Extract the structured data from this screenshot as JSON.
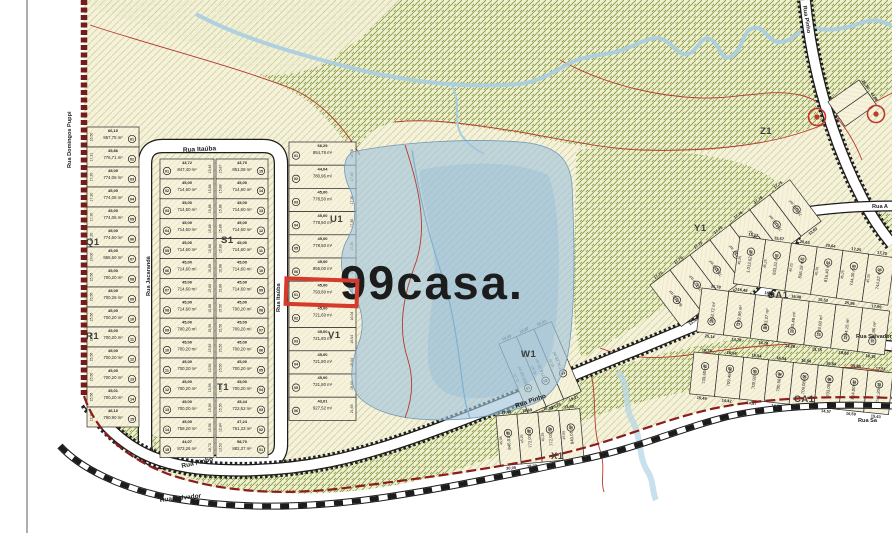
{
  "watermark": {
    "text": "99casa."
  },
  "streets": {
    "itauba": "Rua Itaúba",
    "jacaranda": "Rua Jacarandá",
    "pinho": "Rua Pinho",
    "salvador": "Rua Salvador",
    "salvador_short": "Rua Sa",
    "domingos": "Rua Domingos Puppi",
    "rua_a": "Rua A"
  },
  "highlight": {
    "block": "u1v1",
    "index": 6,
    "color": "#d63a2a"
  },
  "colors": {
    "land": "#f5f0d8",
    "forest_line": "#8a9a45",
    "lake": "#9fc4dc",
    "boundary_red": "#7a1f1a",
    "contour_red": "#b5392e",
    "highlight_red": "#d63a2a",
    "stream_blue": "#a8cde2",
    "road_fill": "#ffffff",
    "ink": "#1c1c1c",
    "watermark_fill": "rgba(255,255,255,0.62)"
  },
  "marker_symbols": [
    "boundary-marker",
    "boundary-marker"
  ],
  "blocks": {
    "q1r1": {
      "label": "Q1",
      "label2": "R1",
      "lots": [
        {
          "n": "01",
          "a": "857,75 m²",
          "f": "66,10",
          "s": "16,50"
        },
        {
          "n": "02",
          "a": "776,71 m²",
          "f": "45,86",
          "s": "17,21"
        },
        {
          "n": "03",
          "a": "774,06 m²",
          "f": "45,00",
          "s": "17,20"
        },
        {
          "n": "04",
          "a": "774,06 m²",
          "f": "45,00",
          "s": "17,20"
        },
        {
          "n": "05",
          "a": "774,06 m²",
          "f": "45,00",
          "s": "17,20"
        },
        {
          "n": "06",
          "a": "774,60 m²",
          "f": "45,00",
          "s": "17,20"
        },
        {
          "n": "07",
          "a": "855,60 m²",
          "f": "45,00",
          "s": "19,00"
        },
        {
          "n": "08",
          "a": "700,20 m²",
          "f": "45,00",
          "s": "15,56"
        },
        {
          "n": "09",
          "a": "700,26 m²",
          "f": "45,00",
          "s": "15,56"
        },
        {
          "n": "10",
          "a": "700,20 m²",
          "f": "45,00",
          "s": "15,56"
        },
        {
          "n": "11",
          "a": "700,20 m²",
          "f": "45,00",
          "s": "15,56"
        },
        {
          "n": "12",
          "a": "700,20 m²",
          "f": "45,00",
          "s": "15,56"
        },
        {
          "n": "13",
          "a": "700,20 m²",
          "f": "45,00",
          "s": "15,56"
        },
        {
          "n": "14",
          "a": "700,20 m²",
          "f": "45,01",
          "s": "15,56"
        },
        {
          "n": "15",
          "a": "790,90 m²",
          "f": "46,10",
          "s": "13,28"
        }
      ]
    },
    "s1t1_a": {
      "label": "S1",
      "lots": [
        {
          "n": "01",
          "a": "847,40 m²",
          "f": "43,72",
          "s": "15,48"
        },
        {
          "n": "02",
          "a": "714,60 m²",
          "f": "45,00",
          "s": "15,88"
        },
        {
          "n": "03",
          "a": "714,50 m²",
          "f": "45,00",
          "s": "15,88"
        },
        {
          "n": "04",
          "a": "714,60 m²",
          "f": "45,00",
          "s": "15,88"
        },
        {
          "n": "05",
          "a": "714,60 m²",
          "f": "45,00",
          "s": "15,88"
        },
        {
          "n": "06",
          "a": "714,60 m²",
          "f": "45,00",
          "s": "15,88"
        },
        {
          "n": "07",
          "a": "714,60 m²",
          "f": "45,00",
          "s": "15,88"
        },
        {
          "n": "08",
          "a": "714,60 m²",
          "f": "45,00",
          "s": "15,88"
        },
        {
          "n": "09",
          "a": "700,20 m²",
          "f": "45,00",
          "s": "15,56"
        },
        {
          "n": "10",
          "a": "700,20 m²",
          "f": "45,00",
          "s": "15,56"
        },
        {
          "n": "11",
          "a": "700,20 m²",
          "f": "45,00",
          "s": "15,56"
        },
        {
          "n": "12",
          "a": "700,20 m²",
          "f": "45,00",
          "s": "15,56"
        },
        {
          "n": "13",
          "a": "700,20 m²",
          "f": "45,00",
          "s": "15,56"
        },
        {
          "n": "14",
          "a": "759,20 m²",
          "f": "45,00",
          "s": "15,56"
        },
        {
          "n": "15",
          "a": "873,26 m²",
          "f": "44,07",
          "s": "18,72"
        }
      ]
    },
    "s1t1_b": {
      "label": "T1",
      "lots": [
        {
          "n": "15",
          "a": "851,08 m²",
          "f": "43,70",
          "s": "15,87"
        },
        {
          "n": "14",
          "a": "714,60 m²",
          "f": "45,00",
          "s": "15,88"
        },
        {
          "n": "13",
          "a": "714,60 m²",
          "f": "45,00",
          "s": "15,88"
        },
        {
          "n": "12",
          "a": "714,60 m²",
          "f": "45,00",
          "s": "15,88"
        },
        {
          "n": "11",
          "a": "714,60 m²",
          "f": "45,00",
          "s": "15,88"
        },
        {
          "n": "10",
          "a": "714,60 m²",
          "f": "45,00",
          "s": "15,88"
        },
        {
          "n": "09",
          "a": "714,60 m²",
          "f": "45,00",
          "s": "15,88"
        },
        {
          "n": "08",
          "a": "700,20 m²",
          "f": "45,00",
          "s": "15,56"
        },
        {
          "n": "07",
          "a": "700,20 m²",
          "f": "45,00",
          "s": "15,56"
        },
        {
          "n": "06",
          "a": "700,20 m²",
          "f": "45,00",
          "s": "15,56"
        },
        {
          "n": "05",
          "a": "700,20 m²",
          "f": "45,00",
          "s": "15,56"
        },
        {
          "n": "04",
          "a": "700,20 m²",
          "f": "45,00",
          "s": "15,56"
        },
        {
          "n": "03",
          "a": "722,62 m²",
          "f": "45,44",
          "s": "15,56"
        },
        {
          "n": "02",
          "a": "761,33 m²",
          "f": "47,24",
          "s": "12,84"
        },
        {
          "n": "01",
          "a": "882,37 m²",
          "f": "58,70",
          "s": "13,53"
        }
      ]
    },
    "u1v1": {
      "label": "U1",
      "label2": "V1",
      "lots": [
        {
          "n": "01",
          "a": "854,78 m²",
          "f": "66,29",
          "s": "16,50"
        },
        {
          "n": "02",
          "a": "780,96 m²",
          "f": "44,04",
          "s": "17,46"
        },
        {
          "n": "03",
          "a": "778,50 m²",
          "f": "45,00",
          "s": "17,30"
        },
        {
          "n": "04",
          "a": "778,50 m²",
          "f": "45,00",
          "s": "17,30"
        },
        {
          "n": "05",
          "a": "778,50 m²",
          "f": "45,00",
          "s": "17,30"
        },
        {
          "n": "06",
          "a": "855,00 m²",
          "f": "45,00",
          "s": "19,05"
        },
        {
          "n": "01",
          "a": "793,80 m²",
          "f": "45,00",
          "s": "17,64"
        },
        {
          "n": "02",
          "a": "721,60 m²",
          "f": "45,00",
          "s": "16,04"
        },
        {
          "n": "03",
          "a": "721,80 m²",
          "f": "45,00",
          "s": "16,04"
        },
        {
          "n": "04",
          "a": "721,80 m²",
          "f": "45,00",
          "s": "16,04"
        },
        {
          "n": "05",
          "a": "721,80 m²",
          "f": "45,00",
          "s": "16,04"
        },
        {
          "n": "06",
          "a": "927,52 m²",
          "f": "43,01",
          "s": "21,65"
        }
      ]
    },
    "w1": {
      "label": "W1",
      "lots": [
        {
          "n": "01",
          "a": "858,68 m²",
          "t": "13,00",
          "s": "41,75",
          "b": "28,02"
        },
        {
          "n": "02",
          "a": "774,38 m²",
          "t": "13,87",
          "s": "45,40",
          "b": "20,26"
        },
        {
          "n": "03",
          "a": "774,19 m²",
          "t": "15,01",
          "s": "45,25",
          "b": "19,21"
        }
      ]
    },
    "x1": {
      "label": "X1",
      "lots": [
        {
          "n": "01",
          "a": "846,01 m²",
          "t": "17,49",
          "s": "45,05",
          "b": "20,05"
        },
        {
          "n": "02",
          "a": "772,01 m²",
          "t": "15,69",
          "s": "45,25",
          "b": "18,23"
        },
        {
          "n": "03",
          "a": "772,01 m²",
          "t": "15,89",
          "s": "45,25",
          "b": "18,23"
        },
        {
          "n": "04",
          "a": "840,01 m²",
          "t": "13,49",
          "s": "45,05",
          "b": "20,05"
        }
      ]
    },
    "y1z1": {
      "label": "Y1",
      "label2": "Z1",
      "lots": [
        {
          "n": "22",
          "a": "844,96 m²",
          "t": "17,70",
          "b": "13,53"
        },
        {
          "n": "15",
          "a": "759,79 m²",
          "t": "17,70",
          "b": "13,53"
        },
        {
          "n": "14",
          "a": "759,60 m²",
          "t": "17,70",
          "b": "13,63"
        },
        {
          "n": "13",
          "a": "761,67 m²",
          "t": "17,70",
          "b": "13,63"
        },
        {
          "n": "12",
          "a": "758,42 m²",
          "t": "17,76",
          "b": "13,53"
        },
        {
          "n": "11",
          "a": "756,42 m²",
          "t": "17,76",
          "b": "13,63"
        },
        {
          "n": "10",
          "a": "756,42 m²",
          "t": "17,76",
          "b": "13,63"
        }
      ]
    },
    "da1_top": {
      "label": "DA1",
      "lots": [
        {
          "n": "01",
          "a": "1.013,52 m²",
          "t": "13,17",
          "s": "45,25"
        },
        {
          "n": "02",
          "a": "833,51 m²",
          "t": "15,57",
          "s": "45,25"
        },
        {
          "n": "03",
          "a": "836,18 m²",
          "t": "20,63",
          "s": "45,25"
        },
        {
          "n": "04",
          "a": "816,40 m²",
          "t": "20,64",
          "s": "45,35"
        },
        {
          "n": "05",
          "a": "744,30 m²",
          "t": "17,25",
          "s": "45,25"
        },
        {
          "n": "06",
          "a": "744,22 m²",
          "t": "17,25",
          "s": "45,25"
        }
      ]
    },
    "da1_bot": {
      "label": "",
      "lots": [
        {
          "n": "04",
          "a": "852,72 m²",
          "t": "31,78",
          "b": "25,14"
        },
        {
          "n": "07",
          "a": "792,98 m²",
          "t": "16,48",
          "b": "14,79"
        },
        {
          "n": "08",
          "a": "803,27 m²",
          "t": "16,48",
          "b": "14,79"
        },
        {
          "n": "25",
          "a": "703,48 m²",
          "t": "16,48",
          "b": "14,79"
        },
        {
          "n": "24",
          "a": "703,08 m²",
          "t": "15,53",
          "b": "13,75"
        },
        {
          "n": "11",
          "a": "844,15 m²",
          "t": "25,96",
          "b": "18,59"
        },
        {
          "n": "10",
          "a": "792,86 m²",
          "t": "17,99",
          "b": "16,15"
        }
      ]
    },
    "ca1": {
      "label": "CA1",
      "lots": [
        {
          "n": "01",
          "a": "739,60 m²",
          "t": "16,78",
          "b": "15,49"
        },
        {
          "n": "02",
          "a": "709,48 m²",
          "t": "16,54",
          "b": "14,42"
        },
        {
          "n": "03",
          "a": "709,92 m²",
          "t": "16,54",
          "b": "14,57"
        },
        {
          "n": "04",
          "a": "700,68 m²",
          "t": "16,54",
          "b": "14,57"
        },
        {
          "n": "05",
          "a": "709,08 m²",
          "t": "16,54",
          "b": "14,57"
        },
        {
          "n": "06",
          "a": "703,06 m²",
          "t": "16,54",
          "b": "14,57"
        },
        {
          "n": "13",
          "a": "814,00 m²",
          "t": "19,48",
          "b": "16,59"
        },
        {
          "n": "12",
          "a": "741,20 m²",
          "t": "17,51",
          "b": "15,43"
        }
      ]
    },
    "edge_ne": {
      "label": "",
      "lots": [
        {
          "n": "",
          "a": "",
          "t": "25,36"
        },
        {
          "n": "",
          "a": "",
          "t": "41,86"
        }
      ]
    }
  }
}
